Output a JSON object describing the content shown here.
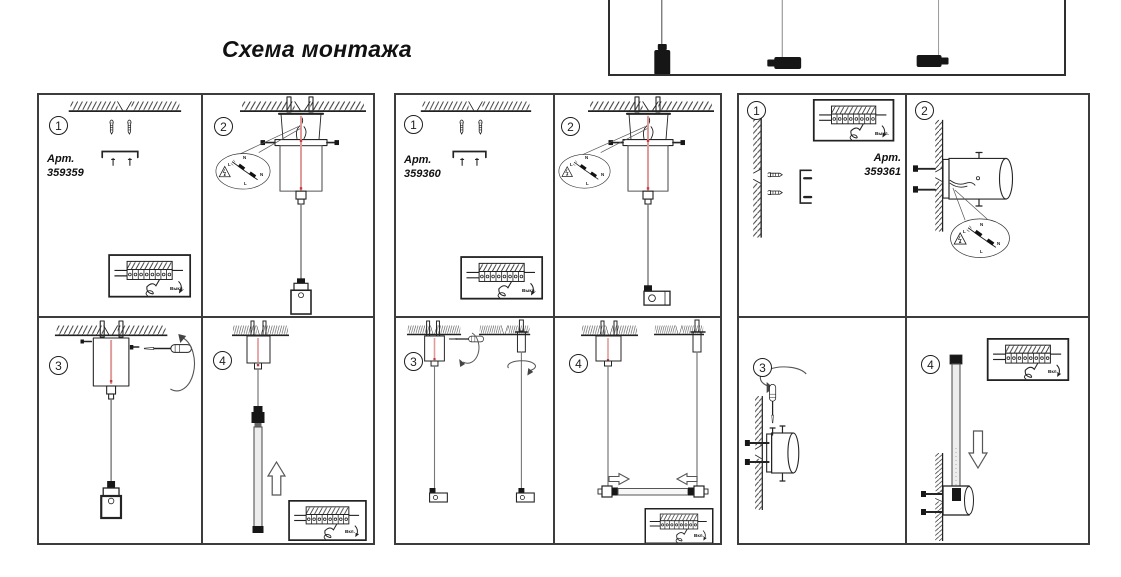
{
  "title": "Схема монтажа",
  "labels": {
    "art": "Арт.",
    "switch_off": "Выкл.",
    "switch_on": "Вкл.",
    "wire_neutral": "N",
    "wire_live": "L"
  },
  "panels": [
    {
      "art_no": "359359",
      "steps": [
        "1",
        "2",
        "3",
        "4"
      ]
    },
    {
      "art_no": "359360",
      "steps": [
        "1",
        "2",
        "3",
        "4"
      ]
    },
    {
      "art_no": "359361",
      "steps": [
        "1",
        "2",
        "3",
        "4"
      ]
    }
  ],
  "colors": {
    "cable_red": "#e19a9a",
    "accent_red": "#c43b3b",
    "line": "#242424"
  }
}
